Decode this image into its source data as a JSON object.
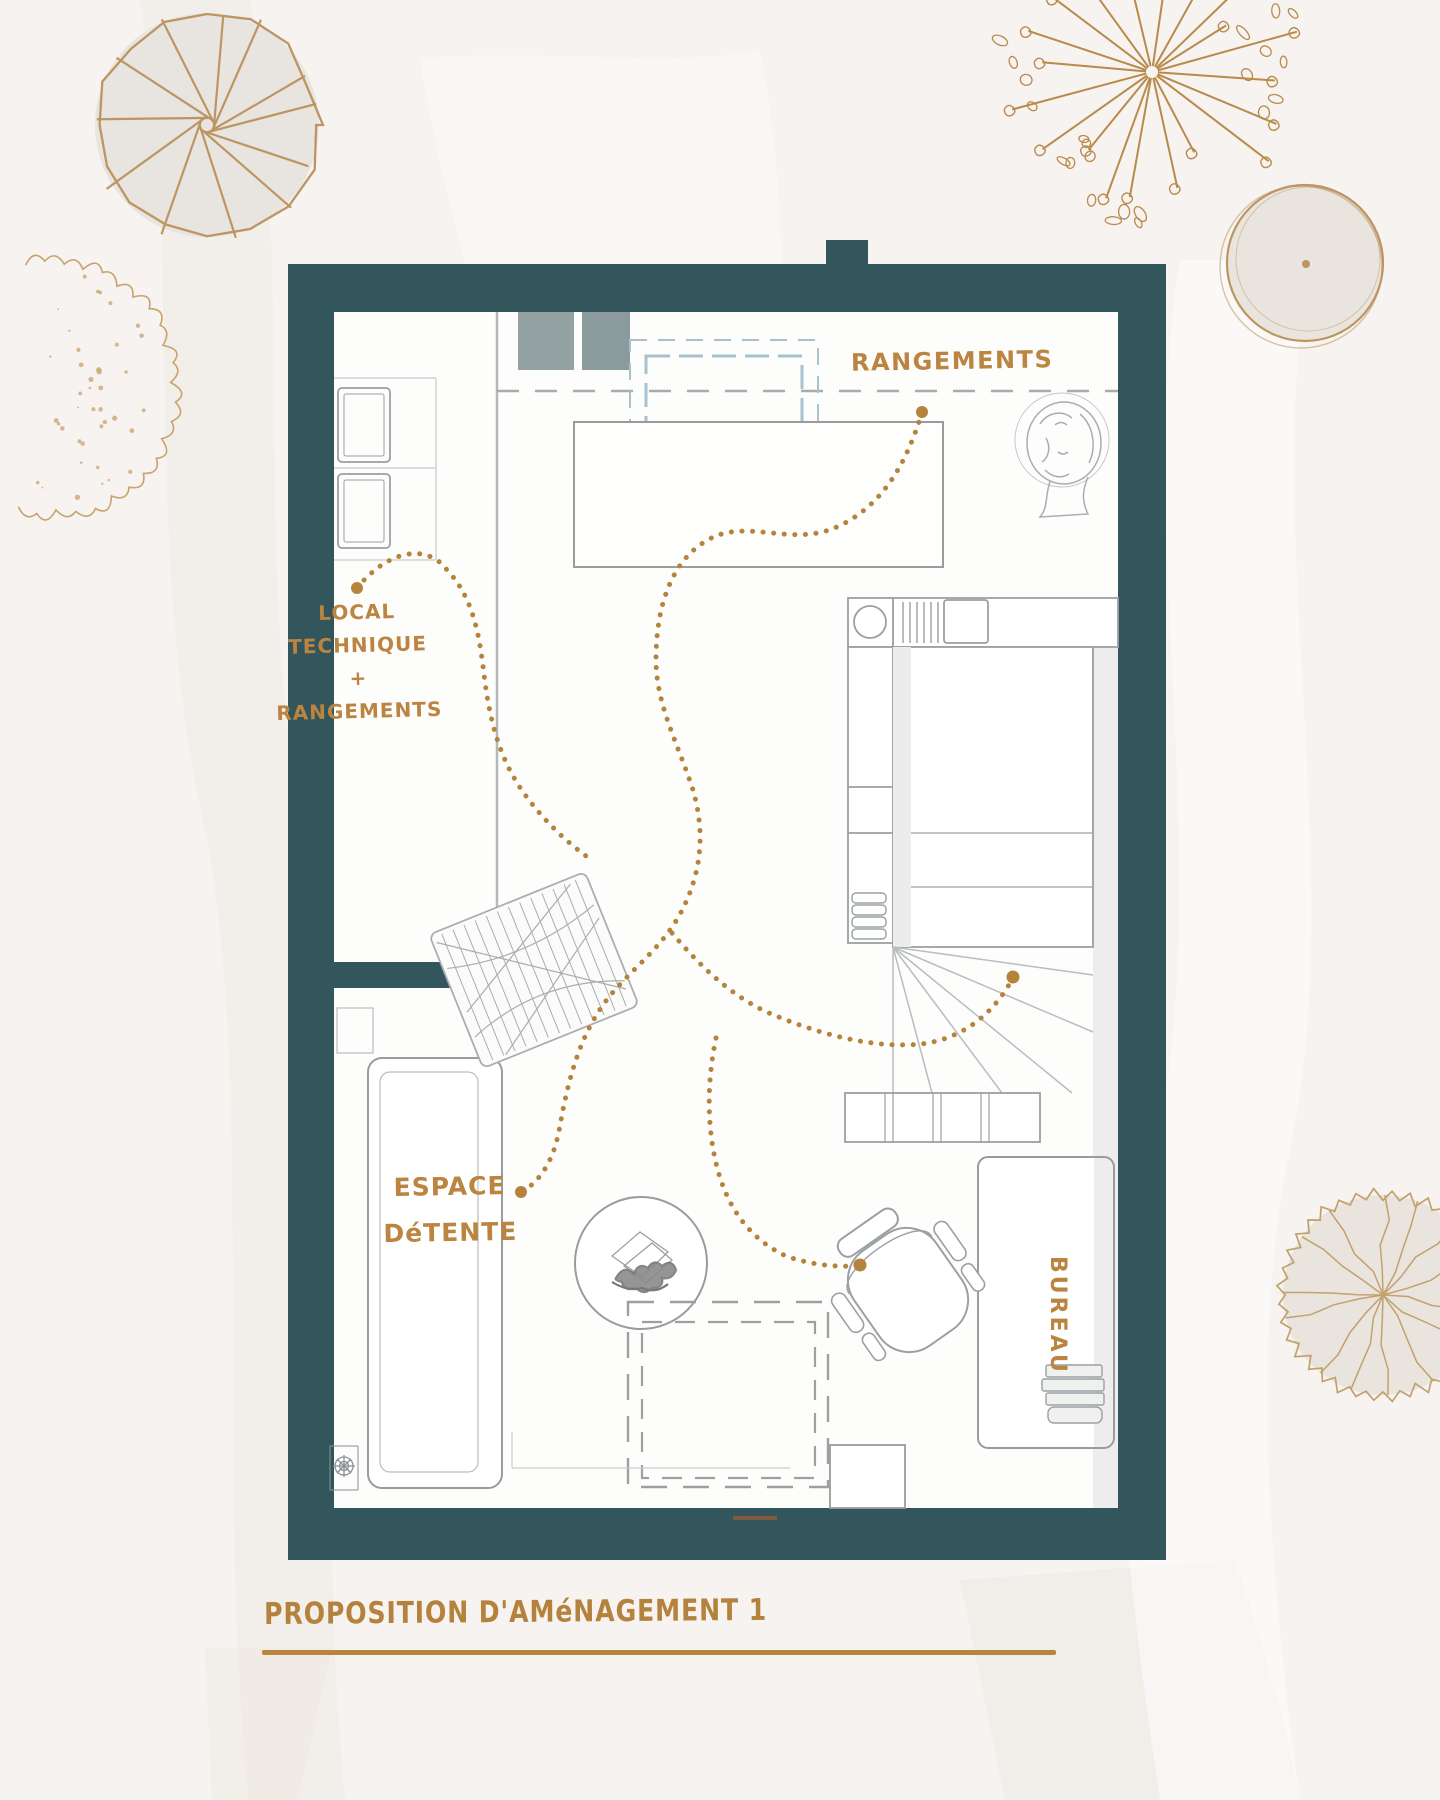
{
  "page": {
    "type": "interior-floor-plan-proposal"
  },
  "title": {
    "text": "PROPOSITION D'AMéNAGEMENT 1"
  },
  "plan_labels": {
    "rangements": "RANGEMENTS",
    "local_technique": {
      "line1": "LOCAL",
      "line2": "TECHNIQUE",
      "line3": "+",
      "line4": "RANGEMENTS"
    },
    "espace_detente": {
      "line1": "ESPACE",
      "line2": "DéTENTE"
    },
    "bureau": "BUREAU"
  },
  "colors": {
    "wall_teal": "#32565b",
    "label_gold": "#bb8440",
    "dotted_gold": "#b5843c",
    "furniture_gray": "#9aa0a3",
    "velux_blue": "#a6c2ce",
    "tree_gold": "#bd9562",
    "background": "#f6f3f0",
    "tree_fill": "#e9e4de"
  }
}
